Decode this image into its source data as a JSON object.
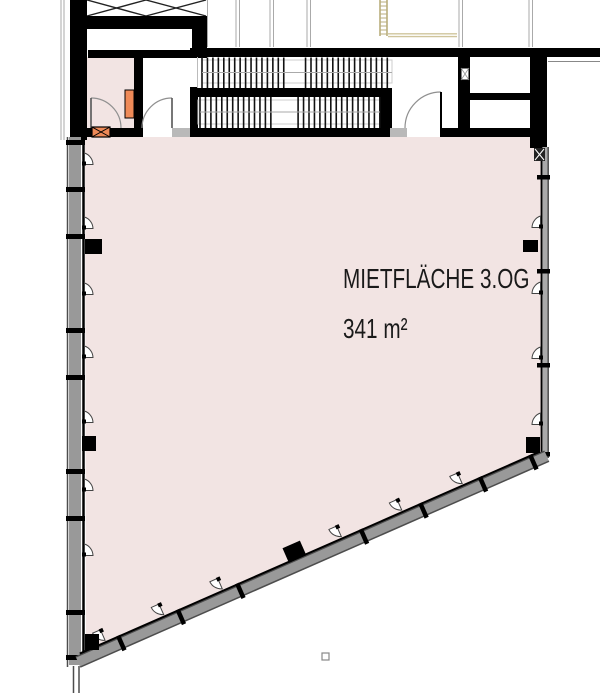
{
  "plan": {
    "labels": {
      "area_name": "MIETFLÄCHE 3.OG",
      "area_size": "341 m²"
    },
    "icons": [
      "window-opener-icon",
      "elevator-x-brace-icon",
      "fire-damper-x-icon",
      "duct-marker-icon",
      "ladder-icon",
      "shaft-vent-icon",
      "door-swing-arc"
    ],
    "colors": {
      "background": "#ffffff",
      "room_fill": "#f2e4e3",
      "wall": "#000000",
      "facade_fill": "#999999",
      "facade_edge": "#4d4d4d",
      "facade_inner": "#000000",
      "projection_line": "#aaaaaa",
      "stair_tread": "#111111",
      "stair_rail": "#aaaaaa",
      "stair_outline": "#cccccc",
      "threshold": "#b9b9b9",
      "door_arc": "#909090",
      "door_leaf": "#555555",
      "orange": "#ef8a58",
      "ladder": "#b9ae7c",
      "ladder_line": "#cfc49b",
      "marker_border": "#888888",
      "text": "#1a1a1a"
    }
  }
}
